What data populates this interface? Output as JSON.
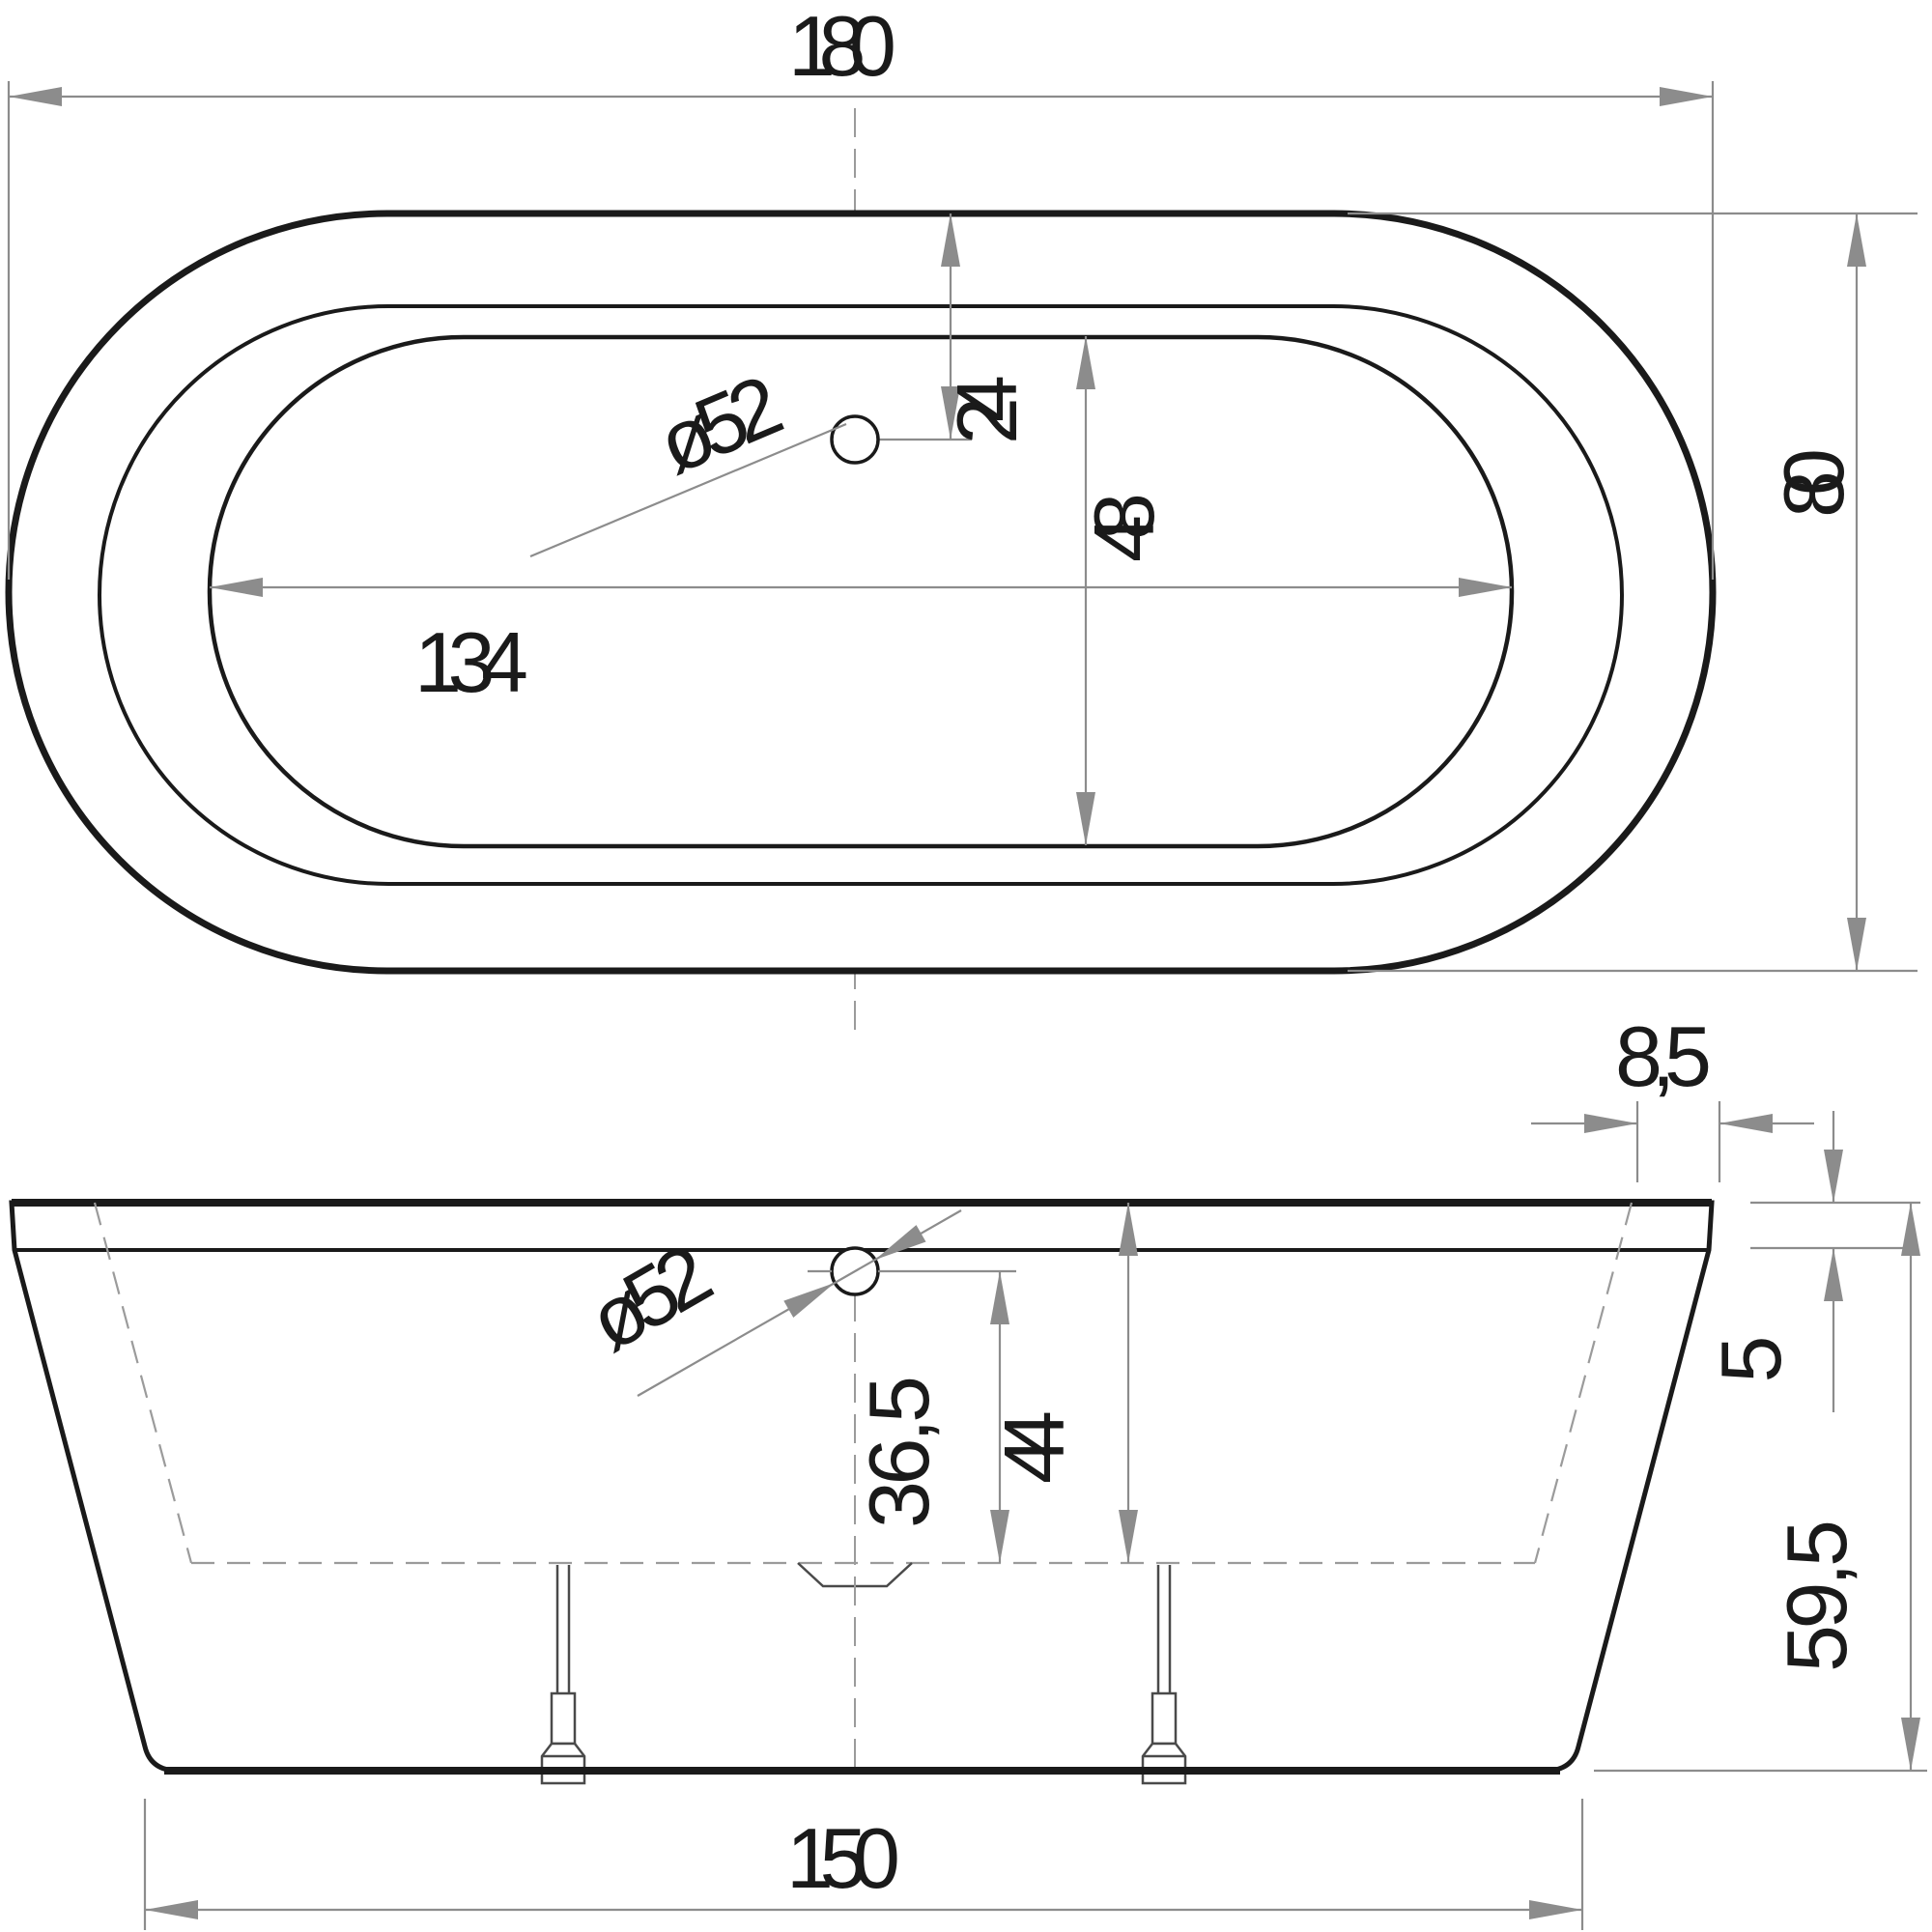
{
  "drawing": {
    "title": "Bathtub technical drawing, two orthographic views",
    "units": "cm",
    "colors": {
      "object_line": "#1a1a1a",
      "dimension_line": "#8c8c8c",
      "hidden_line": "#9b9b9b",
      "background": "#ffffff"
    },
    "top_view": {
      "name": "plan view (top)",
      "dims": {
        "length": {
          "label": "180",
          "value": 180
        },
        "width": {
          "label": "80",
          "value": 80
        },
        "inner_length": {
          "label": "134",
          "value": 134
        },
        "drain_offset": {
          "label": "24",
          "value": 24
        },
        "inner_width_span": {
          "label": "48",
          "value": 48
        },
        "drain_diameter": {
          "label": "ø52",
          "value": 52
        }
      }
    },
    "front_view": {
      "name": "front elevation",
      "dims": {
        "rim_overhang": {
          "label": "8,5",
          "value": 8.5
        },
        "rim_height": {
          "label": "5",
          "value": 5
        },
        "total_height": {
          "label": "59,5",
          "value": 59.5
        },
        "drain_to_bottom": {
          "label": "36,5",
          "value": 36.5
        },
        "rim_to_bottom": {
          "label": "44",
          "value": 44
        },
        "base_length": {
          "label": "150",
          "value": 150
        },
        "drain_diameter": {
          "label": "ø52",
          "value": 52
        }
      }
    }
  }
}
